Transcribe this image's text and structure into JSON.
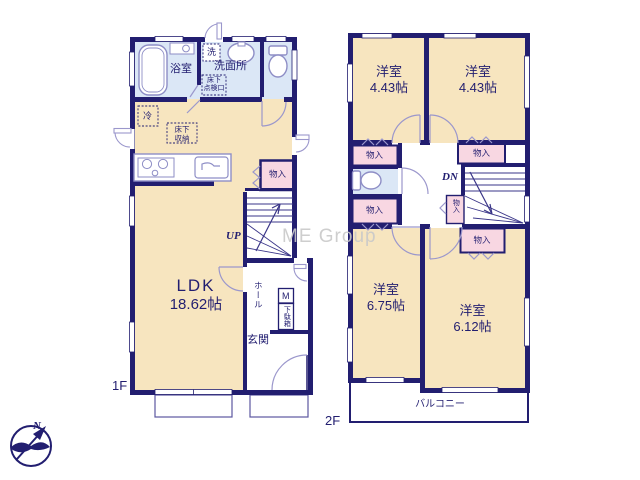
{
  "watermark": "ME Group",
  "compass": {
    "north_label": "N"
  },
  "floor1": {
    "floor_label": "1F",
    "ldk": {
      "name": "LDK",
      "size": "18.62帖"
    },
    "bathroom": "浴室",
    "washer": "洗",
    "washroom": "洗面所",
    "underfloor_access": [
      "床下",
      "点検口"
    ],
    "refrigerator": "冷",
    "underfloor_storage": [
      "床下",
      "収納"
    ],
    "closet": "物入",
    "stairs": "UP",
    "hall": "ホール",
    "meter_box": "M",
    "shoe_cabinet": "下駄箱",
    "entrance": "玄関"
  },
  "floor2": {
    "floor_label": "2F",
    "bedroom_nw": {
      "name": "洋室",
      "size": "4.43帖"
    },
    "bedroom_ne": {
      "name": "洋室",
      "size": "4.43帖"
    },
    "bedroom_sw": {
      "name": "洋室",
      "size": "6.75帖"
    },
    "bedroom_se": {
      "name": "洋室",
      "size": "6.12帖"
    },
    "closets": [
      "物入",
      "物入",
      "物入",
      "物入",
      "物入"
    ],
    "stairs": "DN",
    "balcony": "バルコニー"
  },
  "colors": {
    "wall": "#221e70",
    "room": "#f7e5bf",
    "wet_area": "#dbe7f6",
    "closet": "#f8d7e2",
    "watermark": "#c9c9c9"
  }
}
